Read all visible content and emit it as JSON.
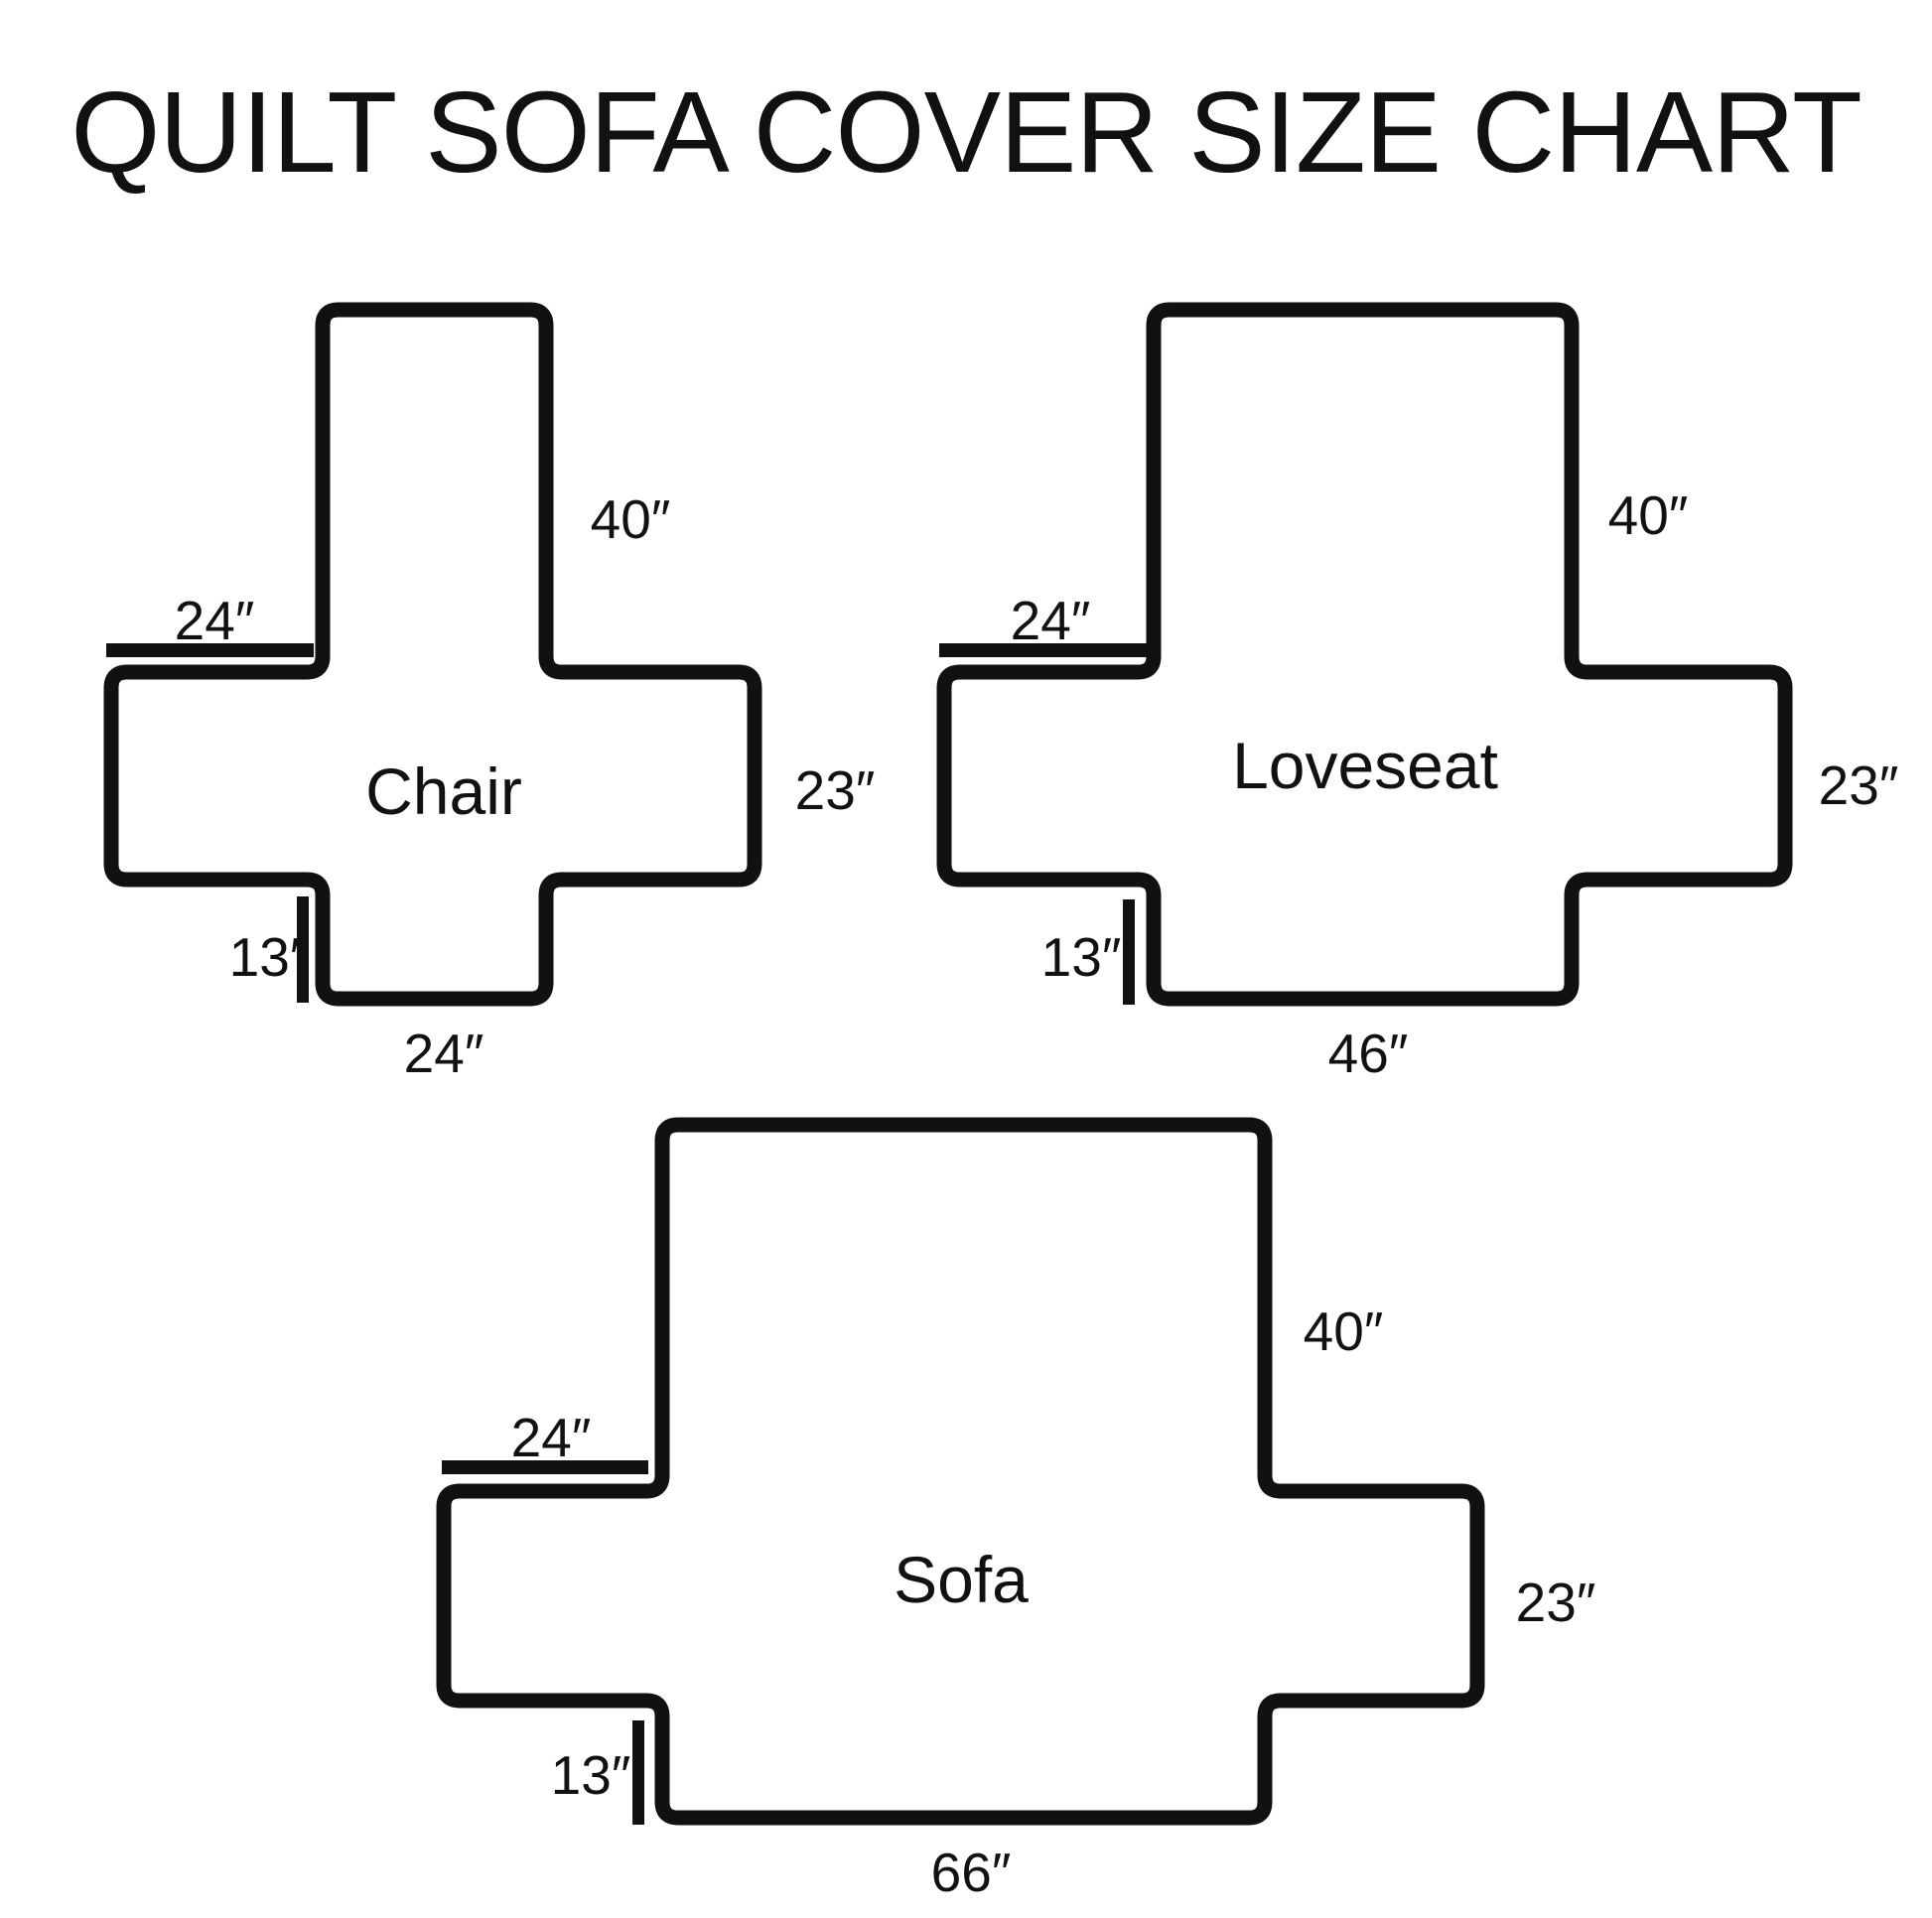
{
  "title": "QUILT SOFA COVER SIZE CHART",
  "colors": {
    "line": "#111111",
    "background": "#ffffff",
    "text": "#111111"
  },
  "diagrams": [
    {
      "name": "Chair",
      "labels": {
        "back_height": "40″",
        "arm_top_width": "24″",
        "side_depth": "23″",
        "skirt_height": "13″",
        "bottom_width": "24″"
      }
    },
    {
      "name": "Loveseat",
      "labels": {
        "back_height": "40″",
        "arm_top_width": "24″",
        "side_depth": "23″",
        "skirt_height": "13″",
        "bottom_width": "46″"
      }
    },
    {
      "name": "Sofa",
      "labels": {
        "back_height": "40″",
        "arm_top_width": "24″",
        "side_depth": "23″",
        "skirt_height": "13″",
        "bottom_width": "66″"
      }
    }
  ]
}
